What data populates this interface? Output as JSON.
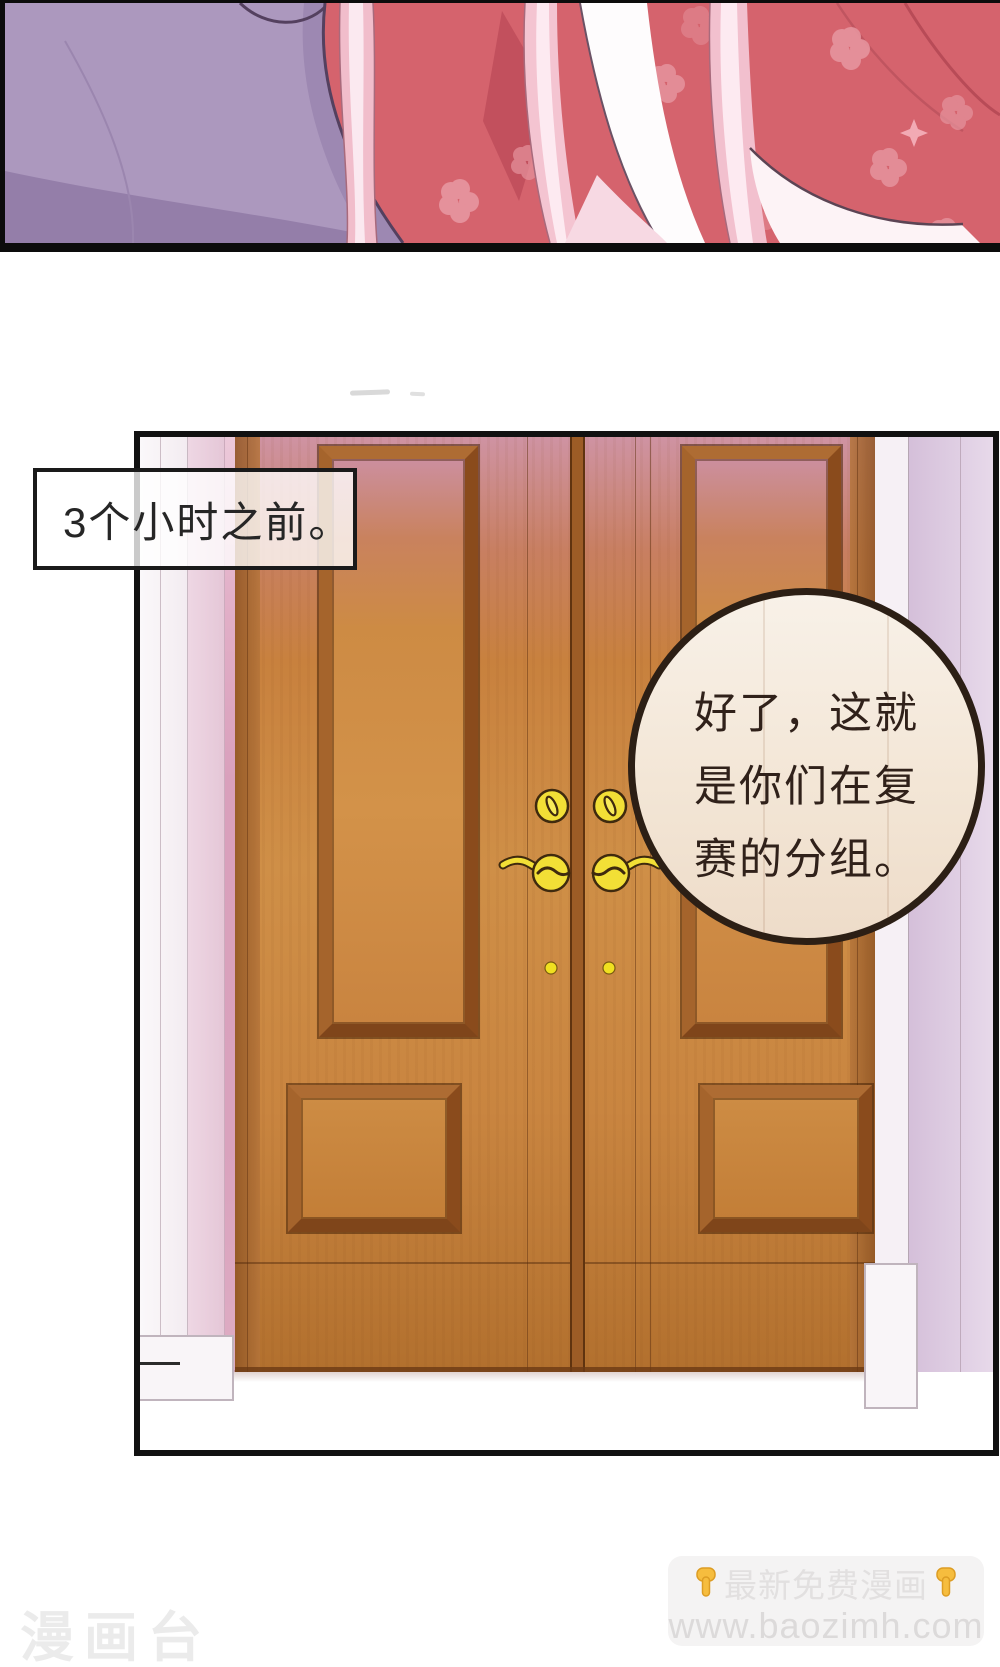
{
  "panel_caption": {
    "text": "3个小时之前。"
  },
  "speech_bubble": {
    "lines": [
      "好了，这就",
      "是你们在复",
      "赛的分组。"
    ],
    "full_text": "好了，这就是你们在复赛的分组。"
  },
  "watermark_left": {
    "text": "漫画台"
  },
  "promo_badge": {
    "title": "最新免费漫画",
    "url": "www.baozimh.com"
  },
  "icons": {
    "left_hand": "hand-pointing-down-icon",
    "right_hand": "hand-pointing-down-icon"
  },
  "colors": {
    "door_wood": "#c9823e",
    "door_frame_dark": "#7f451a",
    "handle_gold": "#f2df36",
    "wall_pink": "#d9a0bc",
    "wall_lavender": "#d3bdd8",
    "bubble_fill": "#f4e7d8",
    "bubble_border": "#2c1f15",
    "kimono_red": "#d5636d",
    "robe_purple": "#ac98be",
    "hair_pink": "#f2c0ce",
    "panel_border": "#111111",
    "badge_bg": "#f4f3f3",
    "watermark_gray": "#ebebeb"
  }
}
